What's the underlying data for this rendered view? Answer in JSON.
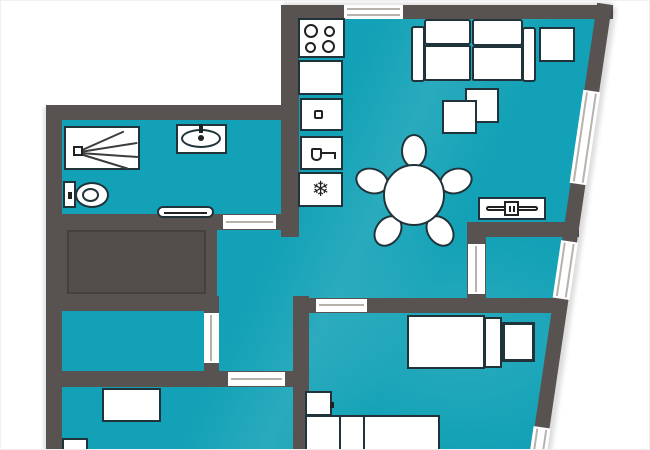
{
  "colors": {
    "floor": "#12a1b6",
    "wall": "#585351",
    "wall_inner": "#44403e",
    "outline": "#20333a",
    "window_line": "#b7b2ac",
    "glyph": "#222222",
    "outside": "#ffffff"
  },
  "icons": {
    "snowflake_char": "❄",
    "names": [
      "shower-icon",
      "washbasin-icon",
      "toilet-icon",
      "stove-burners-icon",
      "kitchen-sink-icon",
      "tap-icon",
      "snowflake-icon"
    ]
  },
  "plan": {
    "type": "apartment-floor-plan",
    "openings": {
      "windows": 4,
      "door_gaps": 5
    },
    "rooms": [
      {
        "name": "bathroom",
        "furniture": [
          "shower",
          "washbasin",
          "toilet",
          "radiator"
        ]
      },
      {
        "name": "kitchen-living-dining",
        "furniture": [
          "stove",
          "counter",
          "sink-unit",
          "tap-unit",
          "freezer",
          "sofa",
          "side-table",
          "coffee-table-back",
          "coffee-table-front",
          "dining-table",
          "chair",
          "chair",
          "chair",
          "chair",
          "chair",
          "tv-sideboard"
        ]
      },
      {
        "name": "stair-core",
        "furniture": []
      },
      {
        "name": "hallway",
        "furniture": []
      },
      {
        "name": "bedroom-left",
        "furniture": []
      },
      {
        "name": "bedroom-bottom-left",
        "furniture": [
          "desk",
          "nightstand"
        ]
      },
      {
        "name": "bedroom-right",
        "furniture": [
          "single-bed",
          "pillow",
          "nightstand",
          "double-bed",
          "nightstand"
        ]
      },
      {
        "name": "alcove",
        "furniture": []
      }
    ]
  }
}
